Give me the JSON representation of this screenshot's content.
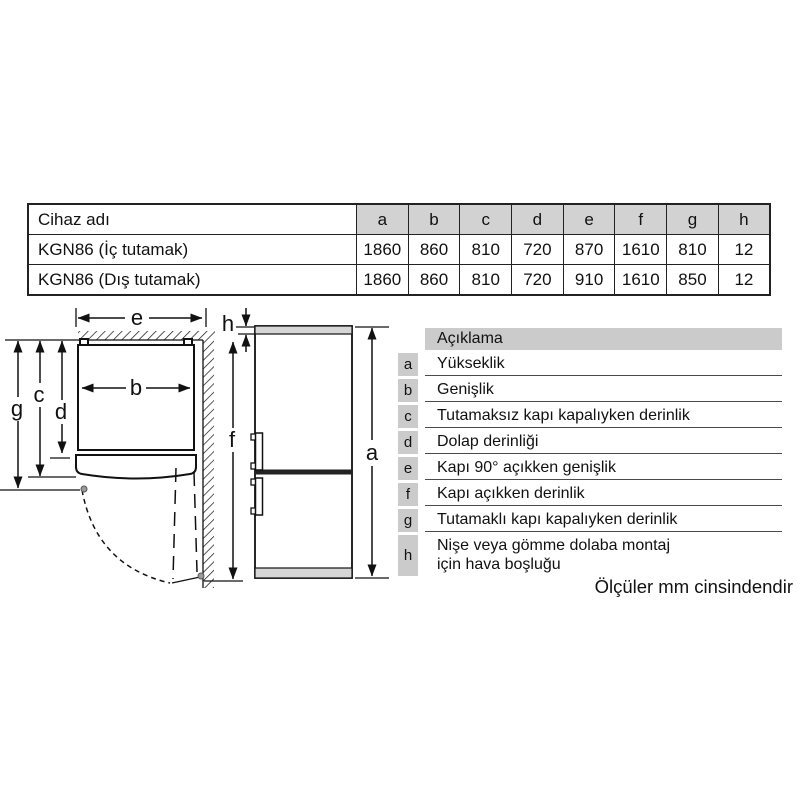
{
  "spec_table": {
    "columns": [
      "Cihaz adı",
      "a",
      "b",
      "c",
      "d",
      "e",
      "f",
      "g",
      "h"
    ],
    "rows": [
      {
        "name": "KGN86 (İç tutamak)",
        "values": [
          "1860",
          "860",
          "810",
          "720",
          "870",
          "1610",
          "810",
          "12"
        ]
      },
      {
        "name": "KGN86 (Dış tutamak)",
        "values": [
          "1860",
          "860",
          "810",
          "720",
          "910",
          "1610",
          "850",
          "12"
        ]
      }
    ],
    "header_bg": "#d2d2d2"
  },
  "diagram": {
    "labels": {
      "a": "a",
      "b": "b",
      "c": "c",
      "d": "d",
      "e": "e",
      "f": "f",
      "g": "g",
      "h": "h"
    }
  },
  "legend": {
    "title": "Açıklama",
    "key_bg": "#cbcbcb",
    "items": [
      {
        "key": "a",
        "text": "Yükseklik"
      },
      {
        "key": "b",
        "text": "Genişlik"
      },
      {
        "key": "c",
        "text": "Tutamaksız kapı kapalıyken derinlik"
      },
      {
        "key": "d",
        "text": "Dolap derinliği"
      },
      {
        "key": "e",
        "text": "Kapı 90° açıkken genişlik"
      },
      {
        "key": "f",
        "text": "Kapı açıkken derinlik"
      },
      {
        "key": "g",
        "text": "Tutamaklı kapı kapalıyken derinlik"
      },
      {
        "key": "h",
        "text": "Nişe veya gömme dolaba montaj için hava boşluğu"
      }
    ]
  },
  "footer": {
    "note": "Ölçüler mm cinsindendir"
  }
}
